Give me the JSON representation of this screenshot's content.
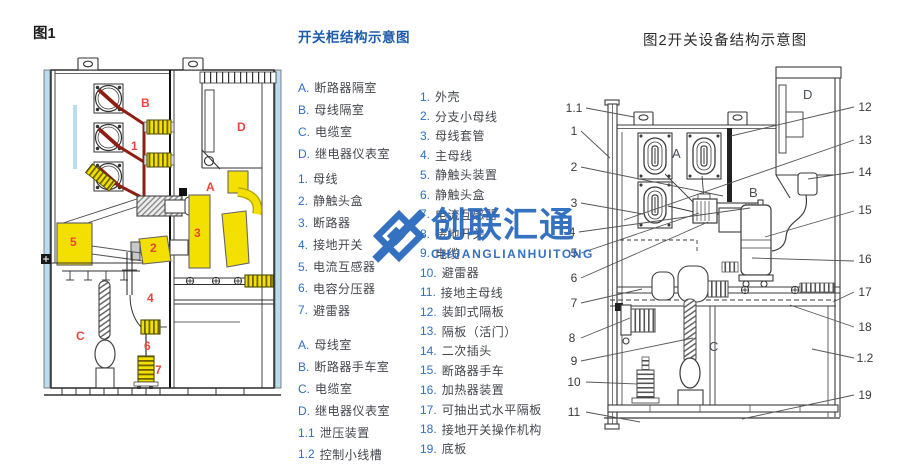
{
  "fig1": {
    "caption": "图1",
    "labels": {
      "A": "A",
      "B": "B",
      "C": "C",
      "D": "D",
      "n1": "1",
      "n2": "2",
      "n3": "3",
      "n4": "4",
      "n5": "5",
      "n6": "6",
      "n7": "7"
    },
    "colors": {
      "busbar": "#8f1d12",
      "yellow": "#f3e000",
      "lightblue": "#b9dcee",
      "label_red": "#e8453a"
    }
  },
  "legend1": {
    "title": "开关柜结构示意图",
    "groups": {
      "letters": [
        {
          "num": "A.",
          "text": "断路器隔室"
        },
        {
          "num": "B.",
          "text": "母线隔室"
        },
        {
          "num": "C.",
          "text": "电缆室"
        },
        {
          "num": "D.",
          "text": "继电器仪表室"
        }
      ],
      "numbers": [
        {
          "num": "1.",
          "text": "母线"
        },
        {
          "num": "2.",
          "text": "静触头盒"
        },
        {
          "num": "3.",
          "text": "断路器"
        },
        {
          "num": "4.",
          "text": "接地开关"
        },
        {
          "num": "5.",
          "text": "电流互感器"
        },
        {
          "num": "6.",
          "text": "电容分压器"
        },
        {
          "num": "7.",
          "text": "避雷器"
        }
      ],
      "rooms": [
        {
          "num": "A.",
          "text": "母线室"
        },
        {
          "num": "B.",
          "text": "断路器手车室"
        },
        {
          "num": "C.",
          "text": "电缆室"
        },
        {
          "num": "D.",
          "text": "继电器仪表室"
        },
        {
          "num": "1.1",
          "text": "泄压装置"
        },
        {
          "num": "1.2",
          "text": "控制小线槽"
        }
      ]
    }
  },
  "legend2": {
    "items": [
      {
        "num": "1.",
        "text": "外壳"
      },
      {
        "num": "2.",
        "text": "分支小母线"
      },
      {
        "num": "3.",
        "text": "母线套管"
      },
      {
        "num": "4.",
        "text": "主母线"
      },
      {
        "num": "5.",
        "text": "静触头装置"
      },
      {
        "num": "6.",
        "text": "静触头盒"
      },
      {
        "num": "7.",
        "text": "电流互感器"
      },
      {
        "num": "8.",
        "text": "接地开关"
      },
      {
        "num": "9.",
        "text": "电缆"
      },
      {
        "num": "10.",
        "text": "避雷器"
      },
      {
        "num": "11.",
        "text": "接地主母线"
      },
      {
        "num": "12.",
        "text": "装卸式隔板"
      },
      {
        "num": "13.",
        "text": "隔板（活门）"
      },
      {
        "num": "14.",
        "text": "二次插头"
      },
      {
        "num": "15.",
        "text": "断路器手车"
      },
      {
        "num": "16.",
        "text": "加热器装置"
      },
      {
        "num": "17.",
        "text": "可抽出式水平隔板"
      },
      {
        "num": "18.",
        "text": "接地开关操作机构"
      },
      {
        "num": "19.",
        "text": "底板"
      }
    ]
  },
  "fig2": {
    "title": "图2开关设备结构示意图",
    "labels": {
      "A": "A",
      "B": "B",
      "C": "C",
      "D": "D"
    },
    "callouts_left": [
      "1.1",
      "1",
      "2",
      "3",
      "4",
      "5",
      "6",
      "7",
      "8",
      "9",
      "10",
      "11"
    ],
    "callouts_right": [
      "12",
      "13",
      "14",
      "15",
      "16",
      "17",
      "18",
      "1.2",
      "19"
    ]
  },
  "watermark": {
    "cn": "创联汇通",
    "en": "CHUANGLIANHUITONG",
    "color": "#2b6abe"
  }
}
